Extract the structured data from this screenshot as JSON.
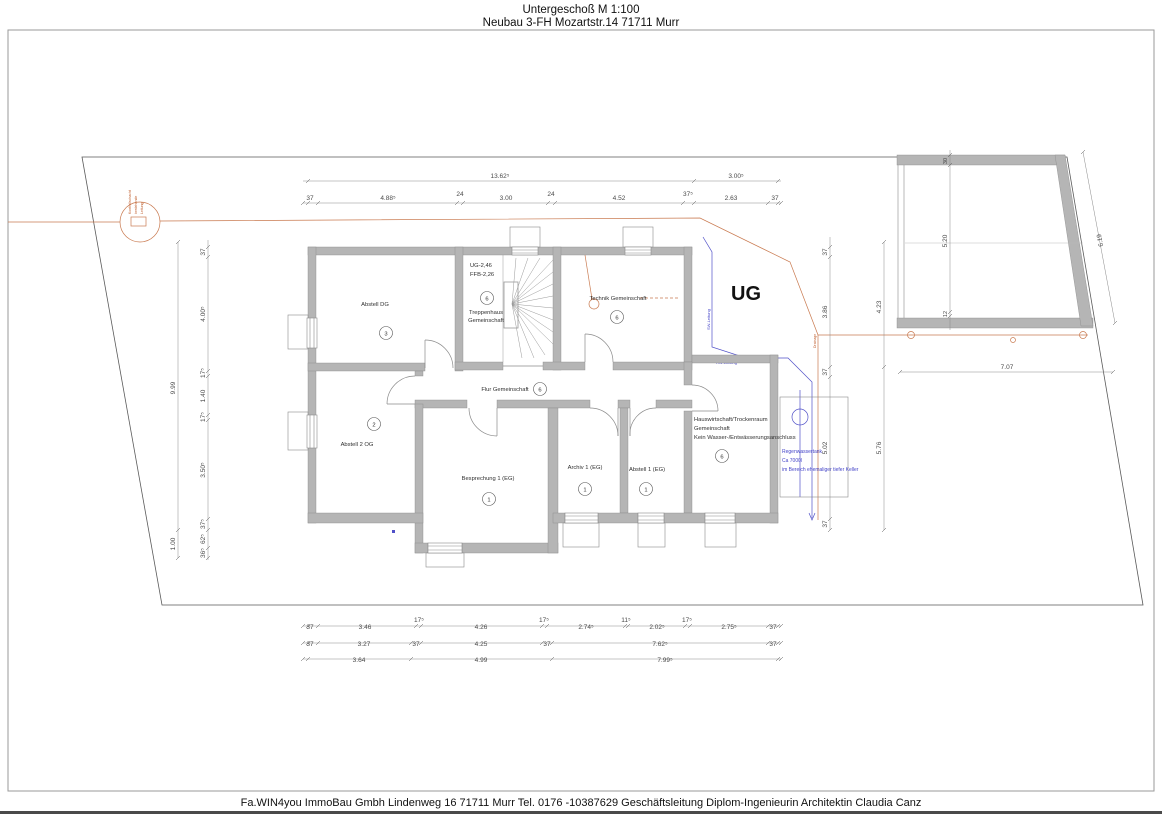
{
  "title": {
    "line1": "Untergeschoß M 1:100",
    "line2": "Neubau 3-FH Mozartstr.14 71711 Murr"
  },
  "footer": "Fa.WIN4you ImmoBau Gmbh Lindenweg 16 71711 Murr Tel. 0176 -10387629 Geschäftsleitung Diplom-Ingenieurin Architektin Claudia Canz",
  "plan": {
    "building_label": "UG",
    "rooms": [
      {
        "label": "Abstell DG",
        "number": "3"
      },
      {
        "label": "Abstell 2 OG",
        "number": "2"
      },
      {
        "label": "Technik Gemeinschaft",
        "number": "6"
      },
      {
        "label": "Flur Gemeinschaft",
        "number": "6"
      },
      {
        "label": "Besprechung 1 (EG)",
        "number": "1"
      },
      {
        "label": "Archiv 1 (EG)",
        "number": "1"
      },
      {
        "label": "Abstell 1 (EG)",
        "number": "1"
      },
      {
        "line1": "Hauswirtschaft/Trockenraum",
        "line2": "Gemeinschaft",
        "line3": "Kein Wasser-/Entwässerungsanschluss",
        "number": "6"
      }
    ],
    "stair": {
      "elev1": "UG-2,46",
      "elev2": "FFB-2,26",
      "name1": "Treppenhaus",
      "name2": "Gemeinschaft",
      "number": "6"
    },
    "annotations": {
      "tank_line1": "Regenwassertank",
      "tank_line2": "Ca 7000l",
      "tank_line3": "im Bereich ehemaliger tiefer Keller",
      "manhole_line1": "Kontrollschacht",
      "manhole_line2": "bestehende",
      "manhole_line3": "Leitung",
      "pipe_blue_v": "SW-Leitung",
      "pipe_blue_h": "RW-Leitung",
      "pipe_orange_v": "Drainage"
    }
  },
  "dims": {
    "top_outer": [
      "13.62⁵",
      "3.00⁵"
    ],
    "top_inner": [
      "37",
      "4.88⁵",
      "24",
      "3.00",
      "24",
      "4.52",
      "37⁵",
      "2.63",
      "37"
    ],
    "left_outer": [
      "9.99",
      "1.00"
    ],
    "left_inner": [
      "37",
      "4.00⁵",
      "17⁵",
      "1.40",
      "17⁵",
      "3.50⁵",
      "37⁵",
      "62⁵",
      "36⁵"
    ],
    "right_inner": [
      "37",
      "3.86",
      "37",
      "5.02",
      "37"
    ],
    "right_outer": [
      "4.23",
      "5.76"
    ],
    "bottom_row1": [
      "37",
      "3.46",
      "17⁵",
      "4.26",
      "17⁵",
      "2.74⁵",
      "11⁵",
      "2.02⁵",
      "17⁵",
      "2.75⁵",
      "37"
    ],
    "bottom_row2": [
      "37",
      "3.27",
      "37",
      "4.25",
      "37",
      "7.62⁵",
      "37"
    ],
    "bottom_row3": [
      "3.64",
      "4.99",
      "7.99⁵"
    ],
    "garage_inner": [
      "30",
      "5.20",
      "12"
    ],
    "garage_bottom": "7.07",
    "garage_diag": "6.19"
  },
  "colors": {
    "wall": "#b5b5b5",
    "orange": "#c97a50",
    "blue": "#5050c8"
  }
}
